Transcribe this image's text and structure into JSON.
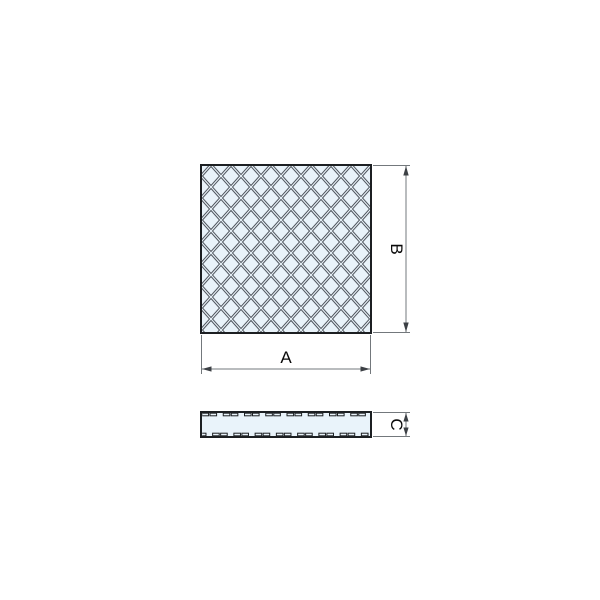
{
  "drawing": {
    "labels": {
      "width": "A",
      "height": "B",
      "thickness": "C"
    },
    "colors": {
      "background": "#ffffff",
      "pad_fill": "#e9f3fa",
      "pattern_line": "#50565e",
      "outline": "#1c1f22",
      "dimension_line": "#73787c",
      "arrow": "#3c4045",
      "text": "#0a0a0a"
    }
  }
}
